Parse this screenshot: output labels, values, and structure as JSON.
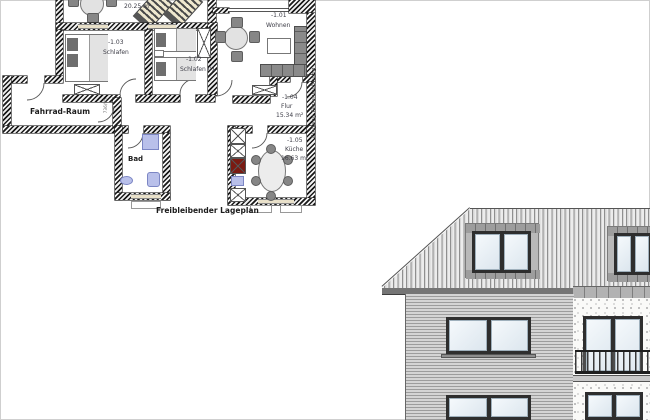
{
  "plan": {
    "caption": "Freibleibender Lageplan",
    "entrance_vertical_label": "Eingang Ferienwohnung",
    "door_size_label": "736/95",
    "terrace": {
      "name": "Terrasse",
      "area": "20.25 m²"
    },
    "rooms": {
      "wohnen": {
        "id": "-1.01",
        "name": "Wohnen"
      },
      "schlafen01": {
        "id": "-1.02",
        "name": "Schlafen 01"
      },
      "schlafen": {
        "id": "-1.03",
        "name": "Schlafen"
      },
      "flur": {
        "id": "-1.04",
        "name": "Flur",
        "area": "15.34 m²"
      },
      "kueche": {
        "id": "-1.05",
        "name": "Küche",
        "area": "16.63 m²"
      },
      "fahrrad": {
        "name": "Fahrrad-Raum"
      },
      "bad": {
        "name": "Bad"
      }
    }
  },
  "colors": {
    "wall_hatch_dark": "#191919",
    "window_strip_beige": "#e9e1ca",
    "bath_fixture_blue": "#b9c0ea",
    "appliance_red": "#7a1a12",
    "roof_stripe_gray": "#8f8f8f",
    "siding_gray": "#9c9c9c",
    "stucco_white": "#fafaf8",
    "frame_dark": "#2e2e2e"
  }
}
